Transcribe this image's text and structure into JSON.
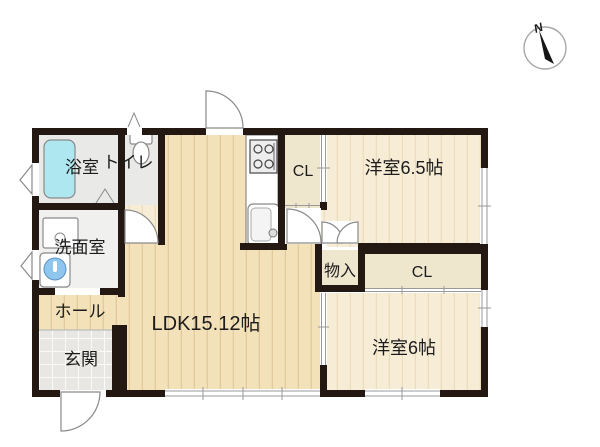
{
  "plan": {
    "type": "floor-plan",
    "compass": {
      "label": "N"
    },
    "rooms": {
      "bathroom": {
        "label": "浴室"
      },
      "toilet": {
        "label": "トイレ"
      },
      "washroom": {
        "label": "洗面室"
      },
      "hall": {
        "label": "ホール"
      },
      "entrance": {
        "label": "玄関"
      },
      "ldk": {
        "label": "LDK15.12帖"
      },
      "closet_kitchen": {
        "label": "CL"
      },
      "bedroom1": {
        "label": "洋室6.5帖"
      },
      "storage": {
        "label": "物入"
      },
      "closet_bedroom2": {
        "label": "CL"
      },
      "bedroom2": {
        "label": "洋室6帖"
      }
    }
  },
  "colors": {
    "wall": "#241813",
    "wood_main": "#f2e1b9",
    "wood_light": "#f7edd7",
    "plank_line": "#d8bd8c",
    "plank_line_light": "#e6d5ae",
    "closet_floor": "#efe6ce",
    "wet_floor": "#e9e9e7",
    "wash_floor": "#f0f0ee",
    "tile_floor": "#e8e7e3",
    "tub": "#aee7f0",
    "sink_blue": "#8ec6ee",
    "outline": "#8a8a8a",
    "text": "#1c1c1c",
    "needle": "#151515"
  }
}
